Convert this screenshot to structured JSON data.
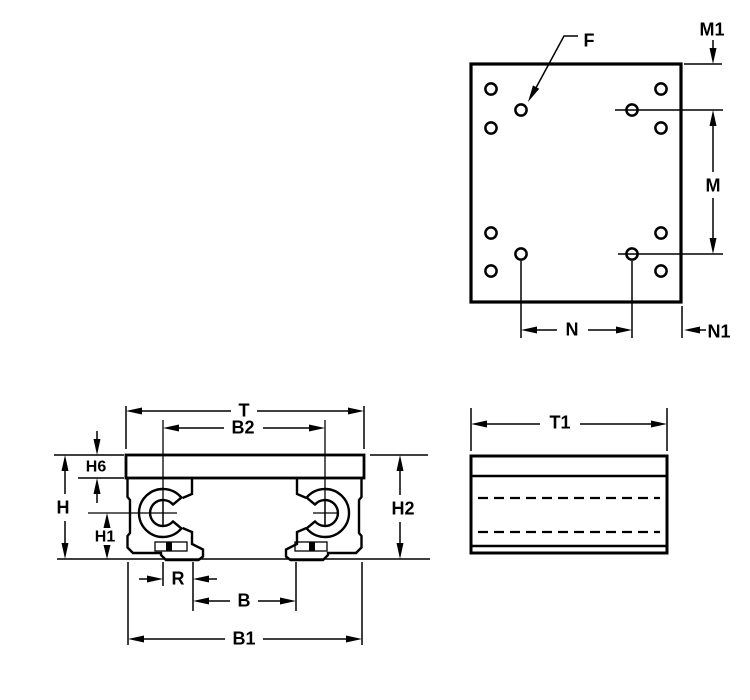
{
  "drawing": {
    "kind": "engineering-dimension-drawing",
    "background_color": "#ffffff",
    "line_color": "#000000",
    "views": {
      "top": {
        "description": "plan view of mounting plate with 12 holes",
        "labels": {
          "f": "F",
          "m1": "M1",
          "m": "M",
          "n": "N",
          "n1": "N1"
        }
      },
      "front": {
        "description": "front view of twin open pillow block with top plate",
        "labels": {
          "t": "T",
          "b2": "B2",
          "h6": "H6",
          "h": "H",
          "h1": "H1",
          "h2": "H2",
          "r": "R",
          "b": "B",
          "b1": "B1"
        }
      },
      "side": {
        "description": "side view with hidden shaft centerlines",
        "labels": {
          "t1": "T1"
        }
      }
    }
  }
}
